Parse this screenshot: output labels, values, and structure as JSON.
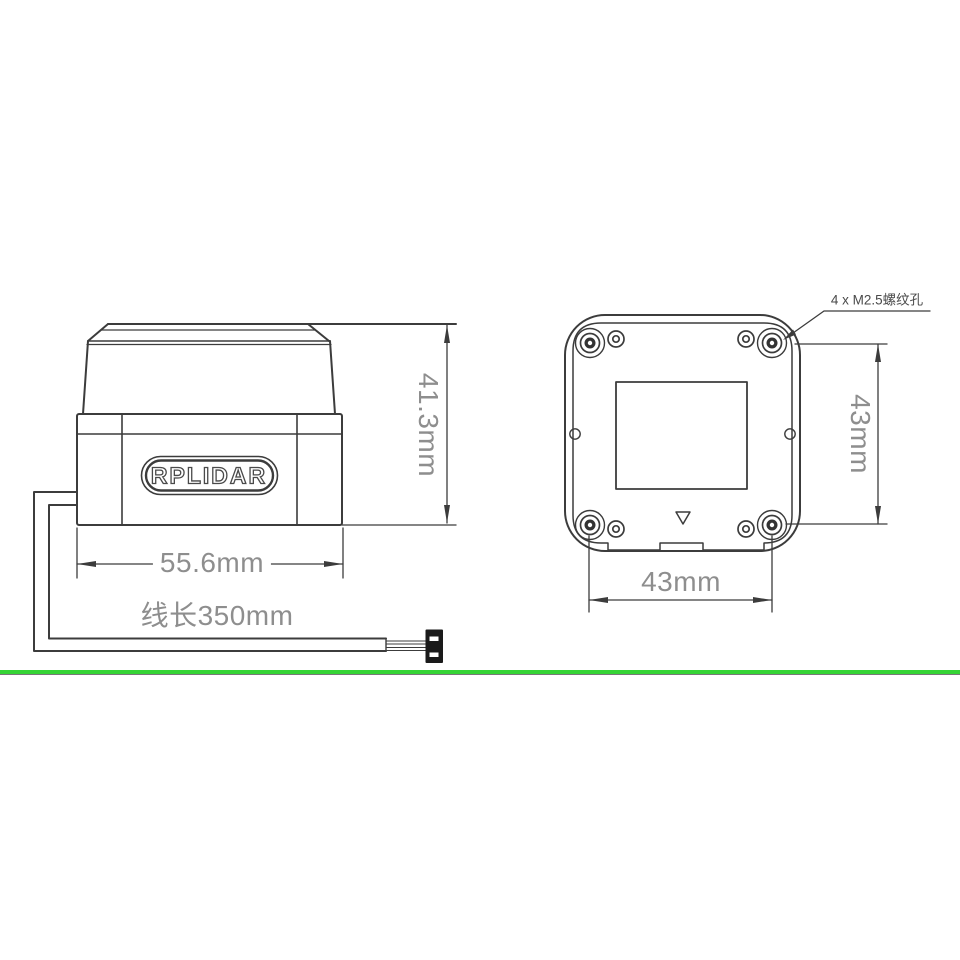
{
  "page": {
    "background": "#ffffff"
  },
  "drawing": {
    "side_view": {
      "logo": "RPLIDAR",
      "height_dim": "41.3mm",
      "width_dim": "55.6mm",
      "cable_length_label": "线长350mm"
    },
    "bottom_view": {
      "mount_hole_label": "4 x M2.5螺纹孔",
      "height_dim": "43mm",
      "width_dim": "43mm"
    },
    "colors": {
      "line": "#3c3c3c",
      "dim_text": "#8e8e8e",
      "label_text": "#4a4a4a",
      "separator_green": "#35d435"
    }
  }
}
